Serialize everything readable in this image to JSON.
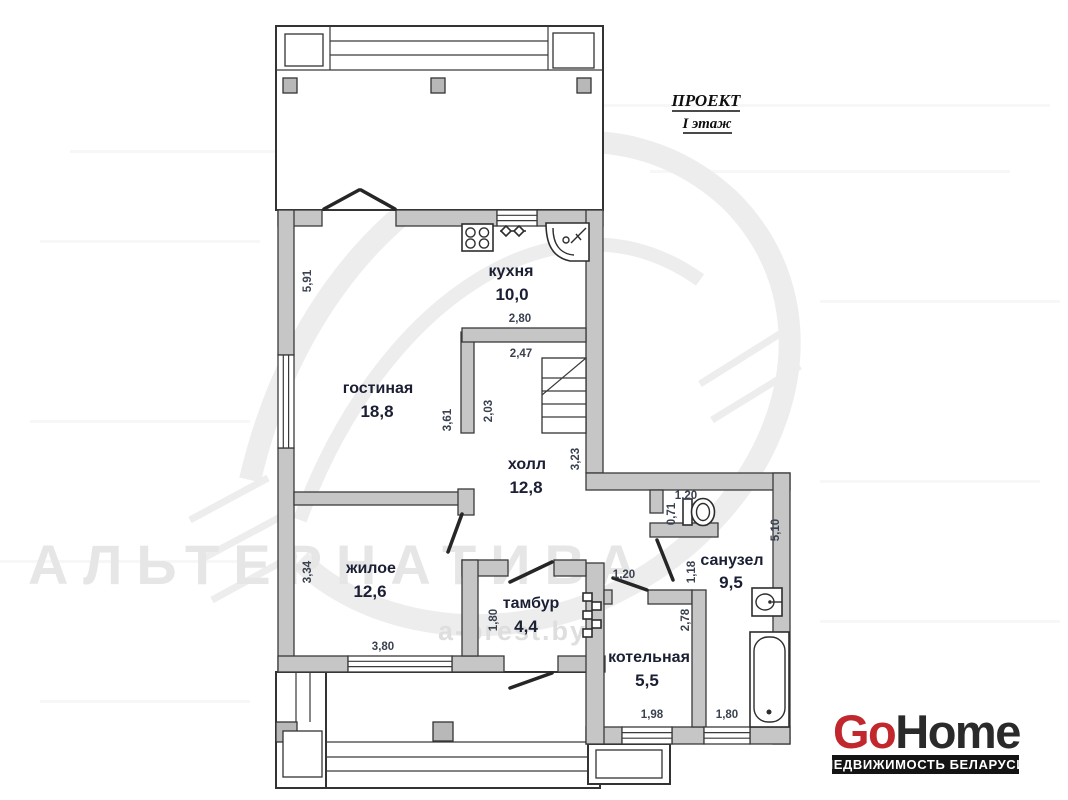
{
  "header": {
    "project": "ПРОЕКТ",
    "floor": "I этаж"
  },
  "watermark": {
    "name": "АЛЬТЕРНАТИВА",
    "site": "a-brest.by"
  },
  "rooms": [
    {
      "name": "кухня",
      "area": "10,0"
    },
    {
      "name": "гостиная",
      "area": "18,8"
    },
    {
      "name": "холл",
      "area": "12,8"
    },
    {
      "name": "жилое",
      "area": "12,6"
    },
    {
      "name": "тамбур",
      "area": "4,4"
    },
    {
      "name": "котельная",
      "area": "5,5"
    },
    {
      "name": "санузел",
      "area": "9,5"
    }
  ],
  "dims": {
    "living_left_h": "5,91",
    "kitchen_w": "2,80",
    "hall_top_w": "2,47",
    "living_wall_h": "3,61",
    "hall_left_h": "2,03",
    "hall_right_h": "3,23",
    "wc_niche_w": "1,20",
    "wc_niche_h": "0,71",
    "san_right_h": "5,10",
    "san_door_h": "1,18",
    "bedroom_left_h": "3,34",
    "boiler_door_w": "1,20",
    "boiler_right_h": "2,78",
    "vestibule_left_h": "1,80",
    "bedroom_bottom_w": "3,80",
    "boiler_bottom_w": "1,98",
    "bath_bottom_w": "1,80"
  },
  "logo": {
    "part1": "Go",
    "part2": "Home",
    "tagline": "НЕДВИЖИМОСТЬ БЕЛАРУСИ",
    "accent_red": "#c1272d",
    "dark": "#2a2a2a",
    "band": "#141414"
  }
}
